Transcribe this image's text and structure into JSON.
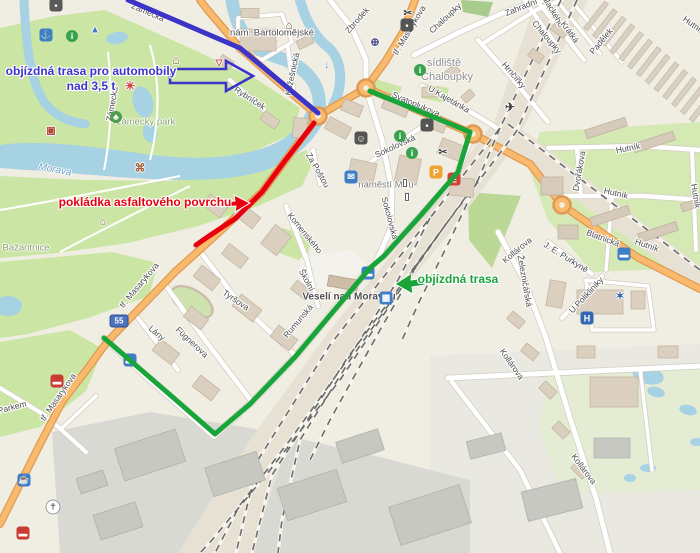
{
  "map": {
    "theme": {
      "water": "#a6d2e3",
      "park": "#cbe6a4",
      "road_primary": "#f9ba6d",
      "blue_route": "#3c33c8",
      "red_route": "#e7000e",
      "green_route": "#19a53a"
    },
    "annotations": [
      {
        "id": "detour-heavy-vehicles",
        "lines": [
          "objízdná trasa pro automobily",
          "nad 3,5 t"
        ],
        "color": "#3c33c8",
        "x": 91,
        "y": 64,
        "arrow": {
          "points": [
            [
              170,
              69
            ],
            [
              226,
              69
            ],
            [
              226,
              61
            ],
            [
              253,
              76
            ],
            [
              226,
              91
            ],
            [
              226,
              83
            ],
            [
              170,
              83
            ]
          ],
          "fill": "none",
          "stroke": "#3c33c8",
          "width": 2.6
        }
      },
      {
        "id": "asphalt-laying",
        "lines": [
          "pokládka asfaltového povrchu"
        ],
        "color": "#e7000e",
        "x": 145,
        "y": 195,
        "arrow": {
          "points": [
            [
              221,
              203
            ],
            [
              235,
              201
            ],
            [
              234,
              195
            ],
            [
              250,
              203
            ],
            [
              235,
              212
            ],
            [
              236,
              206
            ],
            [
              221,
              207
            ]
          ],
          "fill": "#e7000e",
          "stroke": "#ffffff",
          "width": 1
        }
      },
      {
        "id": "detour",
        "lines": [
          "objízdná trasa"
        ],
        "color": "#19a53a",
        "x": 458,
        "y": 272,
        "arrow": {
          "points": [
            [
              425,
              278
            ],
            [
              411,
              280
            ],
            [
              412,
              273
            ],
            [
              395,
              284
            ],
            [
              413,
              294
            ],
            [
              412,
              287
            ],
            [
              425,
              285
            ]
          ],
          "fill": "#19a53a",
          "stroke": "#ffffff",
          "width": 1
        }
      }
    ],
    "routes": [
      {
        "id": "blue-route",
        "color": "#3c33c8",
        "width": 5,
        "points": [
          [
            128,
            0
          ],
          [
            240,
            48
          ],
          [
            318,
            113
          ]
        ]
      },
      {
        "id": "red-route",
        "color": "#e7000e",
        "width": 5,
        "points": [
          [
            314,
            123
          ],
          [
            284,
            162
          ],
          [
            262,
            192
          ],
          [
            236,
            218
          ],
          [
            212,
            234
          ],
          [
            196,
            245
          ]
        ]
      },
      {
        "id": "green-route",
        "color": "#19a53a",
        "width": 5,
        "points": [
          [
            370,
            91
          ],
          [
            470,
            132
          ],
          [
            458,
            172
          ],
          [
            421,
            215
          ],
          [
            384,
            256
          ],
          [
            370,
            268
          ],
          [
            331,
            314
          ],
          [
            295,
            357
          ],
          [
            250,
            404
          ],
          [
            215,
            434
          ],
          [
            176,
            400
          ],
          [
            139,
            368
          ],
          [
            104,
            338
          ]
        ]
      }
    ],
    "route_shield": {
      "text": "55",
      "x": 119,
      "y": 321
    },
    "street_labels": [
      {
        "t": "Zámecká",
        "x": 148,
        "y": 12,
        "r": 23
      },
      {
        "t": "Zámecká",
        "x": 112,
        "y": 104,
        "r": -80
      },
      {
        "t": "nám. Bartolomějské",
        "x": 272,
        "y": 33,
        "r": 0,
        "s": 9.5
      },
      {
        "t": "Zbrodek",
        "x": 357,
        "y": 20,
        "r": -49
      },
      {
        "t": "tř. Masarykova",
        "x": 409,
        "y": 30,
        "r": -59
      },
      {
        "t": "Chaloupky",
        "x": 445,
        "y": 18,
        "r": -43
      },
      {
        "t": "Zahradní",
        "x": 521,
        "y": 7,
        "r": -22
      },
      {
        "t": "Chaloupky",
        "x": 547,
        "y": 37,
        "r": 50
      },
      {
        "t": "Hrnčířky",
        "x": 514,
        "y": 75,
        "r": 49
      },
      {
        "t": "U Kajetánka",
        "x": 449,
        "y": 99,
        "r": 30
      },
      {
        "t": "Palackého",
        "x": 552,
        "y": 9,
        "r": 60
      },
      {
        "t": "Krátká",
        "x": 570,
        "y": 32,
        "r": 54
      },
      {
        "t": "Padělek",
        "x": 601,
        "y": 41,
        "r": -50
      },
      {
        "t": "Hutník",
        "x": 694,
        "y": 25,
        "r": 35
      },
      {
        "t": "Hutník",
        "x": 628,
        "y": 148,
        "r": -11
      },
      {
        "t": "Hutník",
        "x": 616,
        "y": 193,
        "r": 13
      },
      {
        "t": "Hutník",
        "x": 696,
        "y": 196,
        "r": 80
      },
      {
        "t": "Hutník",
        "x": 647,
        "y": 245,
        "r": 19
      },
      {
        "t": "Dvořákova",
        "x": 579,
        "y": 171,
        "r": -80
      },
      {
        "t": "Blatnická",
        "x": 603,
        "y": 238,
        "r": 20
      },
      {
        "t": "Kollárova",
        "x": 517,
        "y": 250,
        "r": -40
      },
      {
        "t": "Kollárova",
        "x": 512,
        "y": 364,
        "r": 55
      },
      {
        "t": "Kollárova",
        "x": 584,
        "y": 469,
        "r": 53
      },
      {
        "t": "J. E. Purkyně",
        "x": 566,
        "y": 257,
        "r": 32
      },
      {
        "t": "Železničářská",
        "x": 525,
        "y": 281,
        "r": 80
      },
      {
        "t": "U Polikliniky",
        "x": 586,
        "y": 295,
        "r": -47
      },
      {
        "t": "Sokolovská",
        "x": 395,
        "y": 146,
        "r": -25
      },
      {
        "t": "Sokolovská",
        "x": 390,
        "y": 218,
        "r": 75
      },
      {
        "t": "Svatoplukova",
        "x": 416,
        "y": 104,
        "r": 23
      },
      {
        "t": "Kožešnická",
        "x": 292,
        "y": 74,
        "r": -78
      },
      {
        "t": "Rybníček",
        "x": 250,
        "y": 98,
        "r": 33
      },
      {
        "t": "Za Poštou",
        "x": 318,
        "y": 170,
        "r": 60
      },
      {
        "t": "Komenského",
        "x": 305,
        "y": 233,
        "r": 51
      },
      {
        "t": "Školní",
        "x": 307,
        "y": 280,
        "r": 61
      },
      {
        "t": "Rumunská",
        "x": 298,
        "y": 321,
        "r": -50
      },
      {
        "t": "Tyršova",
        "x": 236,
        "y": 300,
        "r": 34
      },
      {
        "t": "Fügnerova",
        "x": 192,
        "y": 342,
        "r": 43
      },
      {
        "t": "Lány",
        "x": 157,
        "y": 333,
        "r": 40
      },
      {
        "t": "tř. Masarykova",
        "x": 139,
        "y": 285,
        "r": -50
      },
      {
        "t": "tř. Masarykova",
        "x": 58,
        "y": 397,
        "r": -55
      },
      {
        "t": "Parkem",
        "x": 12,
        "y": 407,
        "r": -15
      }
    ],
    "place_labels": [
      {
        "t": "sídliště",
        "x": 444,
        "y": 63,
        "cls": "district"
      },
      {
        "t": "Chaloupky",
        "x": 447,
        "y": 77,
        "cls": "district"
      },
      {
        "t": "zámecký park",
        "x": 146,
        "y": 122,
        "cls": "park"
      },
      {
        "t": "náměstí Míru",
        "x": 386,
        "y": 185,
        "cls": "square"
      },
      {
        "t": "Veselí nad Moravou",
        "x": 349,
        "y": 297,
        "cls": "station"
      },
      {
        "t": "Morava",
        "x": 55,
        "y": 170,
        "r": 11,
        "cls": "water"
      },
      {
        "t": "Bažantnice",
        "x": 26,
        "y": 248,
        "cls": "park"
      }
    ],
    "pois": [
      {
        "name": "poi-icon",
        "glyph": "▪",
        "x": 56,
        "y": 5,
        "style": "chip",
        "bg": "#5a5a5a"
      },
      {
        "name": "anchor-icon",
        "glyph": "⚓",
        "x": 46,
        "y": 35,
        "style": "chip",
        "bg": "#3f7ec6"
      },
      {
        "name": "info-icon",
        "glyph": "i",
        "x": 72,
        "y": 36,
        "style": "circle",
        "bg": "#38a24c"
      },
      {
        "name": "camp-icon",
        "glyph": "▲",
        "x": 95,
        "y": 30,
        "style": "plain",
        "fg": "#3f7ec6",
        "size": 10
      },
      {
        "name": "fountain-icon",
        "glyph": "✳",
        "x": 130,
        "y": 86,
        "style": "plain",
        "fg": "#d03a3a",
        "size": 12
      },
      {
        "name": "maze-icon",
        "glyph": "▣",
        "x": 51,
        "y": 131,
        "style": "plain",
        "fg": "#b5483a",
        "size": 10
      },
      {
        "name": "tree-icon",
        "glyph": "♣",
        "x": 116,
        "y": 117,
        "style": "circle",
        "bg": "#4d9e4d"
      },
      {
        "name": "windmill-icon",
        "glyph": "⌘",
        "x": 140,
        "y": 168,
        "style": "plain",
        "fg": "#a2603a",
        "size": 11
      },
      {
        "name": "castle-icon",
        "glyph": "⌂",
        "x": 176,
        "y": 60,
        "style": "plain",
        "fg": "#7a5a3c",
        "size": 12
      },
      {
        "name": "viewpoint-icon",
        "glyph": "▽",
        "x": 219,
        "y": 63,
        "style": "plain",
        "fg": "#c04040",
        "size": 9
      },
      {
        "name": "museum-icon",
        "glyph": "⌂",
        "x": 289,
        "y": 25,
        "style": "plain",
        "fg": "#7a5a3c",
        "size": 12
      },
      {
        "name": "church-icon",
        "glyph": "⌂",
        "x": 103,
        "y": 222,
        "style": "plain",
        "fg": "#7a5a3c",
        "size": 10
      },
      {
        "name": "theatre-icon",
        "glyph": "☺",
        "x": 361,
        "y": 138,
        "style": "chip",
        "bg": "#555555"
      },
      {
        "name": "mail-icon",
        "glyph": "✉",
        "x": 351,
        "y": 177,
        "style": "chip",
        "bg": "#3f7ec6"
      },
      {
        "name": "door-icon",
        "glyph": "▯",
        "x": 405,
        "y": 183,
        "style": "plain",
        "fg": "#555555",
        "size": 10
      },
      {
        "name": "door-icon",
        "glyph": "▯",
        "x": 407,
        "y": 197,
        "style": "plain",
        "fg": "#555555",
        "size": 10
      },
      {
        "name": "info-icon",
        "glyph": "i",
        "x": 420,
        "y": 70,
        "style": "circle",
        "bg": "#38a24c"
      },
      {
        "name": "info-icon",
        "glyph": "i",
        "x": 400,
        "y": 136,
        "style": "circle",
        "bg": "#38a24c"
      },
      {
        "name": "info-icon",
        "glyph": "i",
        "x": 412,
        "y": 153,
        "style": "circle",
        "bg": "#38a24c"
      },
      {
        "name": "shop-icon",
        "glyph": "▪",
        "x": 427,
        "y": 125,
        "style": "chip",
        "bg": "#555555"
      },
      {
        "name": "scissors-icon",
        "glyph": "✂",
        "x": 408,
        "y": 13,
        "style": "plain",
        "fg": "#444444",
        "size": 11
      },
      {
        "name": "camera-icon",
        "glyph": "▪",
        "x": 407,
        "y": 25,
        "style": "chip",
        "bg": "#555555"
      },
      {
        "name": "globe-icon",
        "glyph": "⊕",
        "x": 375,
        "y": 42,
        "style": "plain",
        "fg": "#4a4a8a",
        "size": 11
      },
      {
        "name": "scissors-icon",
        "glyph": "✂",
        "x": 443,
        "y": 152,
        "style": "plain",
        "fg": "#444444",
        "size": 11
      },
      {
        "name": "airfield-icon",
        "glyph": "✈",
        "x": 510,
        "y": 107,
        "style": "plain",
        "fg": "#444444",
        "size": 12
      },
      {
        "name": "parking-icon",
        "glyph": "P",
        "x": 436,
        "y": 172,
        "style": "chip",
        "bg": "#efa22e"
      },
      {
        "name": "supermarket-icon",
        "glyph": "E",
        "x": 454,
        "y": 179,
        "style": "chip",
        "bg": "#d04038"
      },
      {
        "name": "bus-stop-icon",
        "glyph": "▬",
        "x": 368,
        "y": 273,
        "style": "chip",
        "bg": "#3f7ec6"
      },
      {
        "name": "train-station-icon",
        "glyph": "▦",
        "x": 386,
        "y": 298,
        "style": "chip",
        "bg": "#3f7ec6"
      },
      {
        "name": "bus-stop-icon",
        "glyph": "▬",
        "x": 130,
        "y": 360,
        "style": "chip",
        "bg": "#3f7ec6"
      },
      {
        "name": "bus-stop-icon",
        "glyph": "▬",
        "x": 624,
        "y": 254,
        "style": "chip",
        "bg": "#3f7ec6"
      },
      {
        "name": "hospital-icon",
        "glyph": "H",
        "x": 587,
        "y": 318,
        "style": "chip",
        "bg": "#3567b2"
      },
      {
        "name": "emergency-icon",
        "glyph": "✶",
        "x": 620,
        "y": 296,
        "style": "plain",
        "fg": "#3567b2",
        "size": 11
      },
      {
        "name": "cafe-icon",
        "glyph": "☕",
        "x": 24,
        "y": 480,
        "style": "chip",
        "bg": "#3f7ec6"
      },
      {
        "name": "fire-station-icon",
        "glyph": "▬",
        "x": 57,
        "y": 381,
        "style": "chip",
        "bg": "#cc3b33"
      },
      {
        "name": "fire-station-icon",
        "glyph": "▬",
        "x": 23,
        "y": 533,
        "style": "chip",
        "bg": "#cc3b33"
      },
      {
        "name": "church-pin-icon",
        "glyph": "✝",
        "x": 53,
        "y": 507,
        "style": "pin"
      },
      {
        "name": "flow-arrow-icon",
        "glyph": "↓",
        "x": 327,
        "y": 64,
        "style": "plain",
        "fg": "#5b9bd5",
        "size": 12
      }
    ]
  }
}
